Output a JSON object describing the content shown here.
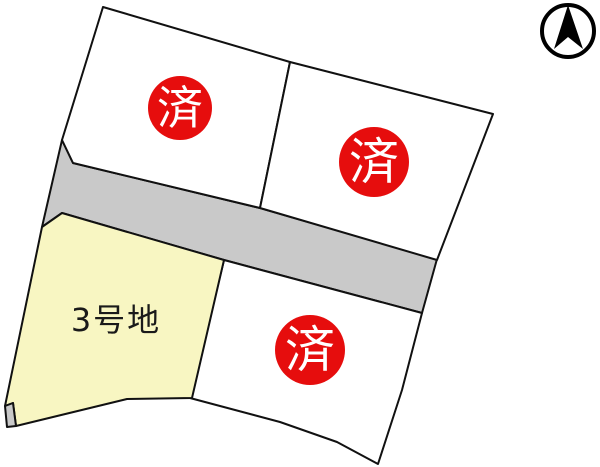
{
  "map": {
    "canvas": {
      "width": 600,
      "height": 467,
      "background": "#ffffff",
      "stroke_color": "#111111",
      "stroke_width": 2
    },
    "legend": {
      "sold_label": "済",
      "sold_badge_fill": "#e60d0d",
      "sold_badge_text_color": "#ffffff",
      "road_fill": "#c9c9c9",
      "available_fill": "#f8f6c2",
      "sold_plot_fill": "#ffffff"
    },
    "parcels": [
      {
        "name": "road-main",
        "kind": "road",
        "points": "62,140 73,163 260,208 437,259 422,313 224,260 62,213 42,227"
      },
      {
        "name": "plot-top-left",
        "kind": "plot",
        "status": "sold",
        "points": "103,7 290,62 260,208 73,163 62,140",
        "badge": {
          "cx": 180,
          "cy": 108,
          "r": 32,
          "font_size": 46
        }
      },
      {
        "name": "plot-top-right",
        "kind": "plot",
        "status": "sold",
        "points": "290,62 493,114 437,260 260,208",
        "badge": {
          "cx": 374,
          "cy": 162,
          "r": 35,
          "font_size": 50
        }
      },
      {
        "name": "plot-bottom-right",
        "kind": "plot",
        "status": "sold",
        "points": "224,260 422,313 402,390 378,464 337,442 280,422 190,398",
        "badge": {
          "cx": 310,
          "cy": 350,
          "r": 35,
          "font_size": 50
        }
      },
      {
        "name": "plot-3",
        "kind": "plot",
        "status": "available",
        "points": "42,227 62,213 224,260 192,398 127,399 16,426 13,403 5,406",
        "label": {
          "text": "3号地",
          "x": 116,
          "y": 320,
          "font_size": 32
        }
      },
      {
        "name": "road-corner-piece",
        "kind": "road",
        "points": "5,406 13,403 16,426 7,427"
      }
    ],
    "compass": {
      "name": "north-arrow",
      "cx": 568,
      "cy": 31,
      "r": 26,
      "ring_stroke_width": 4,
      "arrow_points": "568,5 583,49 568,37 554,49",
      "color": "#000000"
    }
  }
}
